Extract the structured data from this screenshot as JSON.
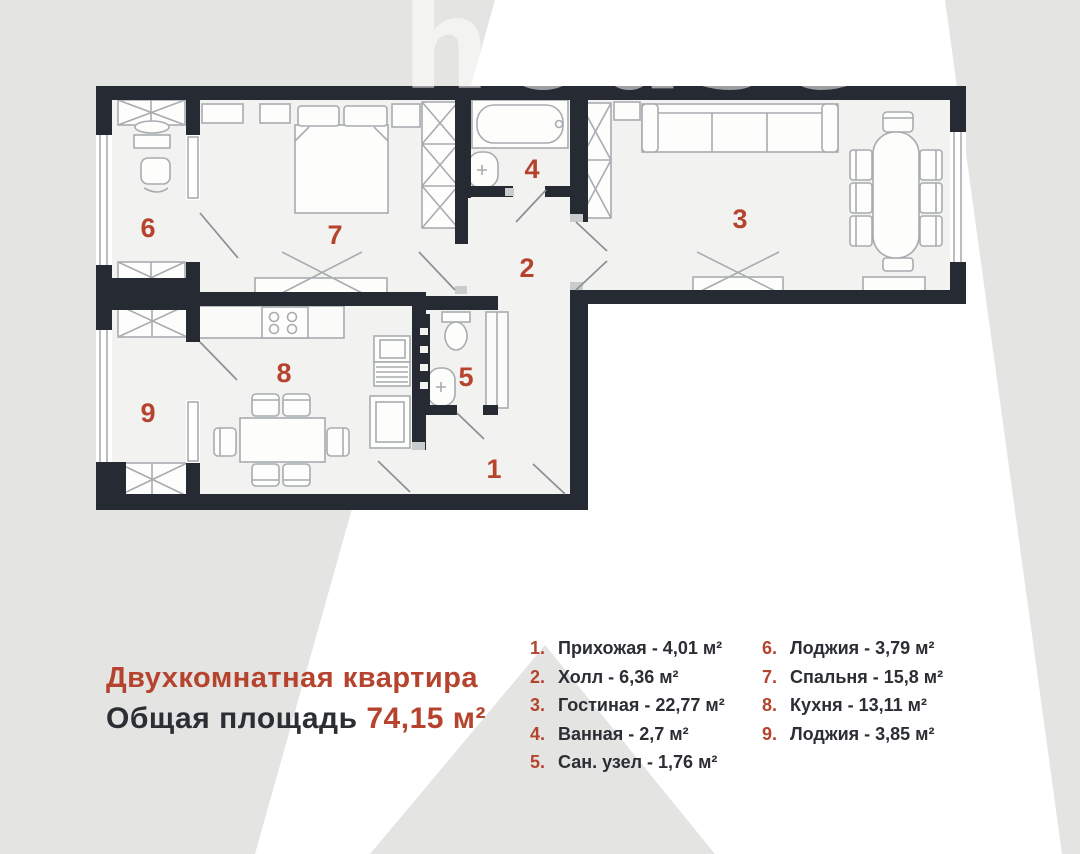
{
  "watermark": "house",
  "title": {
    "heading": "Двухкомнатная квартира",
    "area_label": "Общая площадь ",
    "area_value": "74,15 м²"
  },
  "colors": {
    "accent_red": "#b5432e",
    "wall_dark": "#262a32",
    "floor": "#f2f2f0",
    "background_gray": "#e4e4e3"
  },
  "rooms": [
    {
      "num": "1",
      "num_dot": "1.",
      "name": "Прихожая",
      "area": "4,01 м²",
      "display": "Прихожая - 4,01 м²"
    },
    {
      "num": "2",
      "num_dot": "2.",
      "name": "Холл",
      "area": "6,36 м²",
      "display": "Холл - 6,36 м²"
    },
    {
      "num": "3",
      "num_dot": "3.",
      "name": "Гостиная",
      "area": "22,77 м²",
      "display": "Гостиная - 22,77 м²"
    },
    {
      "num": "4",
      "num_dot": "4.",
      "name": "Ванная",
      "area": "2,7 м²",
      "display": "Ванная - 2,7 м²"
    },
    {
      "num": "5",
      "num_dot": "5.",
      "name": "Сан. узел",
      "area": "1,76 м²",
      "display": "Сан. узел - 1,76 м²"
    },
    {
      "num": "6",
      "num_dot": "6.",
      "name": "Лоджия",
      "area": "3,79 м²",
      "display": "Лоджия - 3,79 м²"
    },
    {
      "num": "7",
      "num_dot": "7.",
      "name": "Спальня",
      "area": "15,8 м²",
      "display": "Спальня - 15,8 м²"
    },
    {
      "num": "8",
      "num_dot": "8.",
      "name": "Кухня",
      "area": "13,11 м²",
      "display": "Кухня - 13,11 м²"
    },
    {
      "num": "9",
      "num_dot": "9.",
      "name": "Лоджия",
      "area": "3,85 м²",
      "display": "Лоджия - 3,85 м²"
    }
  ]
}
